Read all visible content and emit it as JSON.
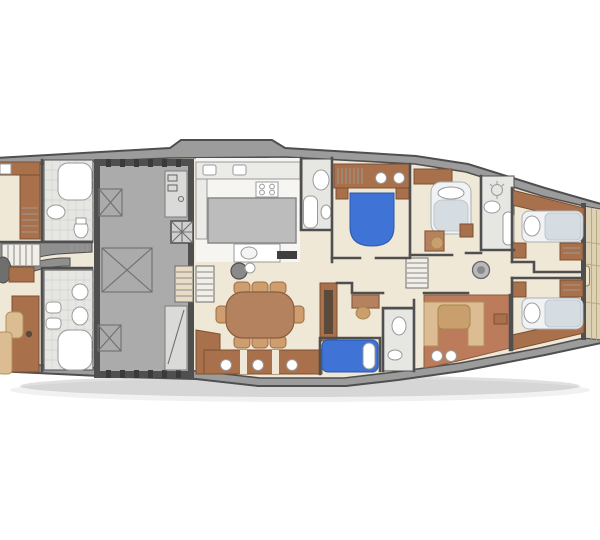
{
  "figure": {
    "kind": "yacht-lower-deck-floor-plan",
    "view": "top-down",
    "visible_text": []
  },
  "palette": {
    "hull": "#9c9c9c",
    "hull-line": "#4f4f4f",
    "floor": "#f0e8d6",
    "floor-light": "#f6f5f1",
    "tile": "#e6e6e3",
    "tile-line": "#d2d2ce",
    "wall": "#4f4f4f",
    "engine": "#ababab",
    "engine-bay": "#dadad8",
    "wood": "#a9714b",
    "wood-mid": "#b5825f",
    "wood-light": "#cf9e6e",
    "terracotta": "#bc7c5c",
    "tan": "#dcbd93",
    "tan-dark": "#c9a06d",
    "blue": "#3f73d6",
    "fixture": "#ffffff",
    "fixture-line": "#9a9a9a",
    "bed-base": "#f1f2f3",
    "bed-grey": "#d6dde2",
    "grey-mid": "#8f8f8f",
    "teak": "#ddd1b5",
    "teak-line": "#bba87f",
    "background": "#ffffff"
  },
  "rooms": [
    "forward-cabin-port",
    "forward-bathroom-port",
    "forward-cabin-starboard",
    "forward-bathroom-starboard",
    "foyer-stairs",
    "engine-room",
    "galley",
    "day-head",
    "double-cabin-port-blue-bed",
    "double-cabin-centre",
    "ensuite-bathroom",
    "salon-dining",
    "lower-cabin-blue-bed",
    "lower-bathroom",
    "aft-lounge",
    "aft-corridor-stairs",
    "aft-guest-cabin-port",
    "aft-guest-cabin-starboard",
    "stern-teak-deck"
  ],
  "icons": [
    "bed-icon",
    "toilet-icon",
    "sink-icon",
    "shower-icon",
    "bathtub-icon",
    "stove-icon",
    "dining-table-icon",
    "chair-icon",
    "sofa-icon",
    "stairs-icon",
    "engine-hatch-icon",
    "porthole-icon",
    "round-table-icon"
  ]
}
